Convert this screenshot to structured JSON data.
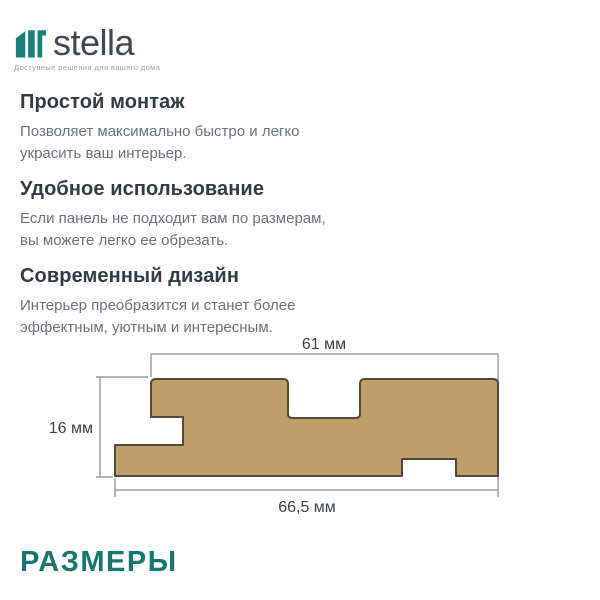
{
  "brand": {
    "name": "stella",
    "tagline": "Доступные решения для вашего дома",
    "logo_color": "#1E7E78",
    "wordmark_color": "#43484F"
  },
  "features": [
    {
      "title": "Простой монтаж",
      "description": "Позволяет максимально быстро и легко\nукрасить ваш интерьер."
    },
    {
      "title": "Удобное использование",
      "description": "Если панель не подходит вам по размерам,\nвы можете легко ее обрезать."
    },
    {
      "title": "Современный дизайн",
      "description": "Интерьер преобразится и станет более\nэффектным, уютным и интересным."
    }
  ],
  "diagram": {
    "type": "panel-cross-section",
    "panel_fill": "#BF9F69",
    "panel_stroke": "#52483C",
    "dimension_line_color": "#85898E",
    "dimensions": {
      "top_width": "61 мм",
      "height": "16 мм",
      "bottom_width": "66,5 мм"
    }
  },
  "section_title": {
    "text": "РАЗМЕРЫ",
    "color": "#17776F"
  }
}
